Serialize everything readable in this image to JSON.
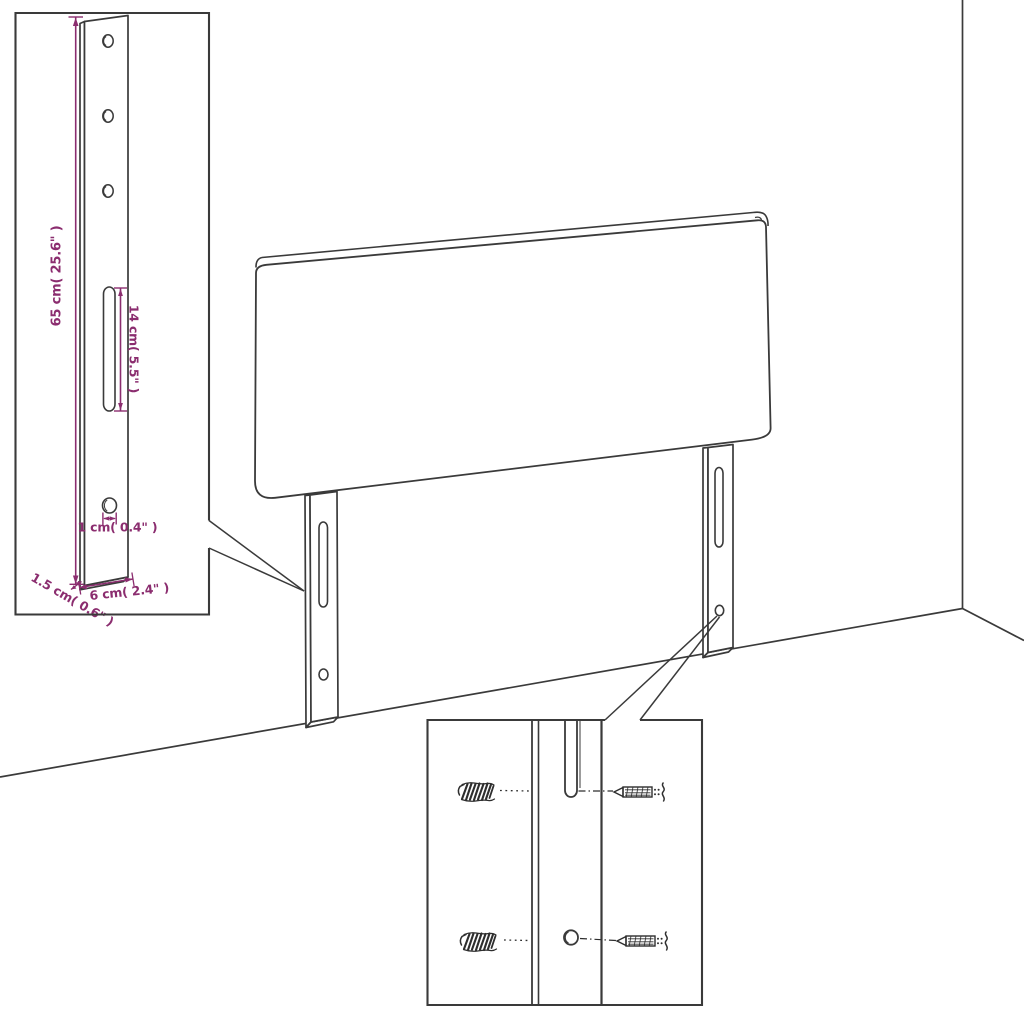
{
  "title": "Headboard assembly dimension diagram",
  "colors": {
    "background": "#ffffff",
    "line": "#3a3a3a",
    "hardware": "#2e2e2e",
    "dimension": "#8b2d6f"
  },
  "leg_detail_inset": {
    "dimensions": {
      "leg_height": "65 cm( 25.6\" )",
      "slot_length": "14 cm( 5.5\" )",
      "hole_width": "1 cm( 0.4\" )",
      "leg_thickness": "1.5 cm( 0.6\" )",
      "leg_width": "6 cm( 2.4\" )"
    },
    "icons": [
      "bracket-leg",
      "screw-hole",
      "adjustment-slot"
    ]
  },
  "mounting_detail_inset": {
    "icons": [
      "wall-plug-icon",
      "screw-icon",
      "adjustment-slot",
      "screw-hole"
    ]
  },
  "scene": {
    "icons": [
      "headboard-panel",
      "mounting-leg",
      "wall-corner"
    ]
  }
}
